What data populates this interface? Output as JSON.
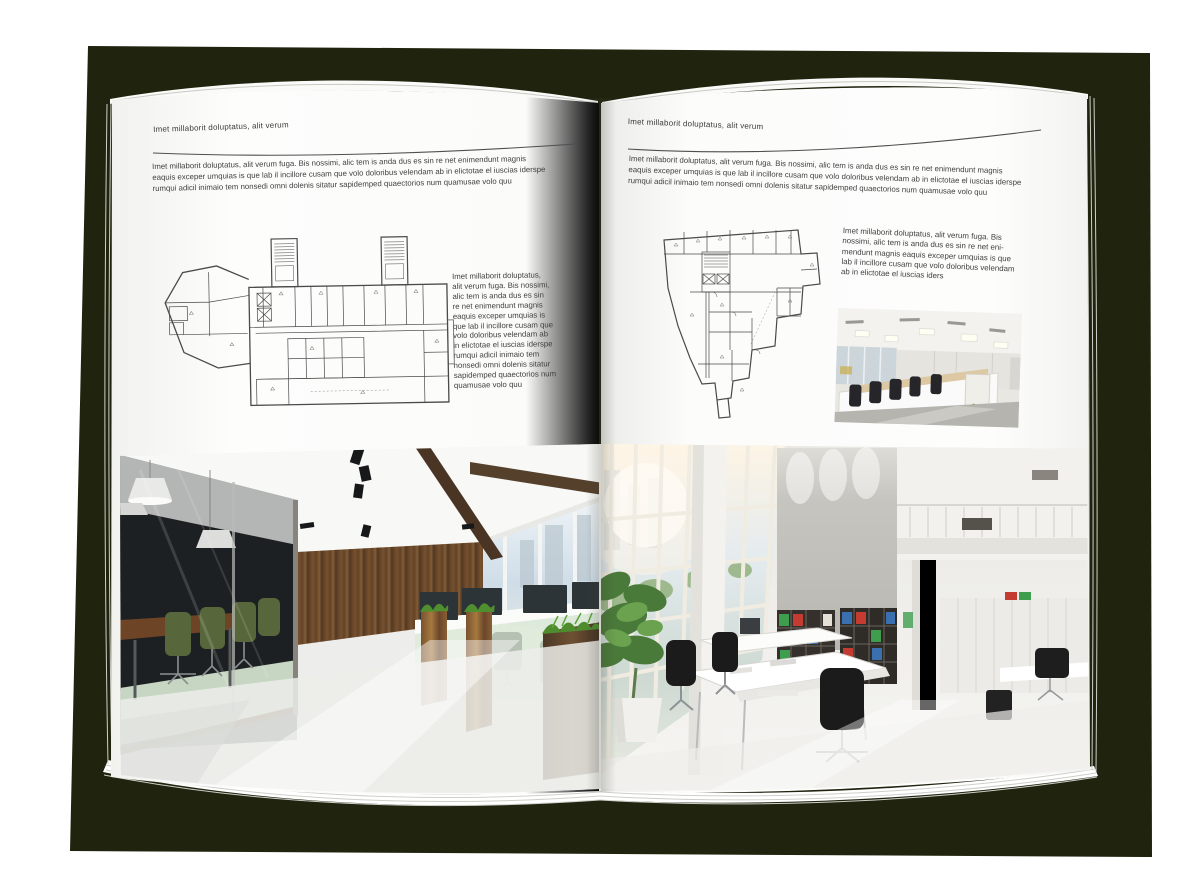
{
  "book": {
    "canvas_color": "#ffffff",
    "backdrop_color": "#20240e",
    "page_color": "#fbfbfa",
    "rule_color": "#4f4f4f"
  },
  "left_page": {
    "header": "Imet millaborit doluptatus, alit verum",
    "body": "Imet millaborit doluptatus, alit verum fuga. Bis nossimi, alic tem is anda dus es sin re net enimendunt magnis\neaquis exceper umquias is que lab il incillore cusam que volo doloribus velendam ab in elictotae el iuscias iderspe\nrumqui adicil inimaio tem nonsedi omni dolenis sitatur sapidemped quaectorios num quamusae volo quu",
    "side_column": "Imet millaborit doluptatus,\nalit verum fuga. Bis nossimi,\nalic tem is anda dus es sin\nre net enimendunt magnis\neaquis exceper umquias is\nque lab il incillore cusam que\nvolo doloribus velendam ab\nin elictotae el iuscias iderspe\nrumqui adicil inimaio tem\nnonsedi omni dolenis sitatur\nsapidemped quaectorios num\nquamusae volo quu",
    "floorplan_name": "elongated-building-floor-plan",
    "photo_name": "office-with-glass-meeting-room-and-wood-wall"
  },
  "right_page": {
    "header": "Imet millaborit doluptatus, alit verum",
    "body": "Imet millaborit doluptatus, alit verum fuga. Bis nossimi, alic tem is anda dus es sin re net enimendunt magnis\neaquis exceper umquias is que lab il incillore cusam que volo doloribus velendam ab in elictotae el iuscias iderspe\nrumqui adicil inimaio tem nonsedi omni dolenis sitatur sapidemped quaectorios num quamusae volo quu",
    "side_column": "Imet millaborit doluptatus, alit verum fuga. Bis\nnossimi, alic tem is anda dus es sin re net eni-\nmendunt magnis eaquis exceper umquias is que\nlab il incillore cusam que volo doloribus velendam\nab in elictotae el iuscias iders",
    "floorplan_name": "irregular-building-floor-plan",
    "small_photo_name": "open-plan-cubicle-office",
    "photo_name": "bright-atrium-office-with-bookshelves"
  }
}
